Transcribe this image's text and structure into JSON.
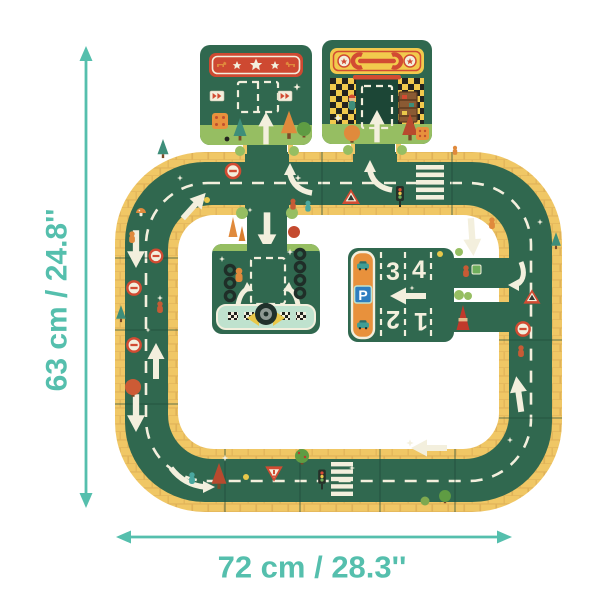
{
  "dimensions": {
    "height_label": "63 cm / 24.8''",
    "width_label": "72 cm / 28.3''"
  },
  "parking_piece": {
    "sign_letter": "P",
    "bay_numbers": [
      "1",
      "2",
      "3",
      "4"
    ]
  },
  "colors": {
    "accent_teal": "#55BFAD",
    "road_green": "#30684F",
    "garage_dark_green": "#1C4636",
    "edge_yellow": "#F0C765",
    "grass_green": "#96BE62",
    "marking_white": "#F3EFDD",
    "banner_red": "#CE4931",
    "banner_yellow": "#F2CA4D",
    "panel_orange": "#E8913C",
    "parking_sign_blue": "#2E7EC0",
    "pit_strip_mint": "#BFE2CE"
  }
}
